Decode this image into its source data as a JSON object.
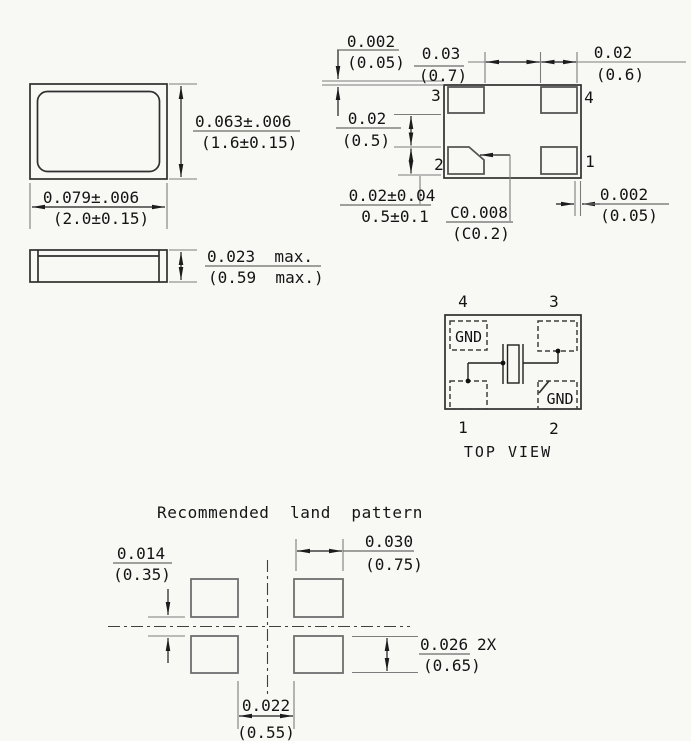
{
  "front_view": {
    "height_dim": {
      "inch": "0.063±.006",
      "mm": "(1.6±0.15)"
    },
    "width_dim": {
      "inch": "0.079±.006",
      "mm": "(2.0±0.15)"
    }
  },
  "side_view": {
    "thickness_dim": {
      "inch": "0.023  max.",
      "mm": "(0.59  max.)"
    }
  },
  "bottom_view": {
    "pins": {
      "p3": "3",
      "p4": "4",
      "p2": "2",
      "p1": "1"
    },
    "top_edge_offset": {
      "inch": "0.002",
      "mm": "(0.05)"
    },
    "pad_gap_horizontal": {
      "inch": "0.03",
      "mm": "(0.7)"
    },
    "pad_width": {
      "inch": "0.02",
      "mm": "(0.6)"
    },
    "pad_gap_vertical": {
      "inch": "0.02",
      "mm": "(0.5)"
    },
    "pad_height": {
      "inch": "0.02±0.04",
      "mm": "0.5±0.1"
    },
    "chamfer": {
      "inch": "C0.008",
      "mm": "(C0.2)"
    },
    "right_edge_offset": {
      "inch": "0.002",
      "mm": "(0.05)"
    }
  },
  "top_view": {
    "caption": "TOP VIEW",
    "pins": {
      "p4": "4",
      "p3": "3",
      "p1": "1",
      "p2": "2"
    },
    "gnd_top_left": "GND",
    "gnd_bottom_right": "GND"
  },
  "land_pattern": {
    "title": "Recommended  land  pattern",
    "vertical_gap": {
      "inch": "0.014",
      "mm": "(0.35)"
    },
    "pad_width": {
      "inch": "0.030",
      "mm": "(0.75)"
    },
    "pad_height": {
      "inch": "0.026",
      "qty": "2X",
      "mm": "(0.65)"
    },
    "horizontal_gap": {
      "inch": "0.022",
      "mm": "(0.55)"
    }
  },
  "colors": {
    "background": "#f8f8f5",
    "line": "#2f2f2f",
    "dim_line": "#7d7d7d",
    "text": "#141414"
  }
}
